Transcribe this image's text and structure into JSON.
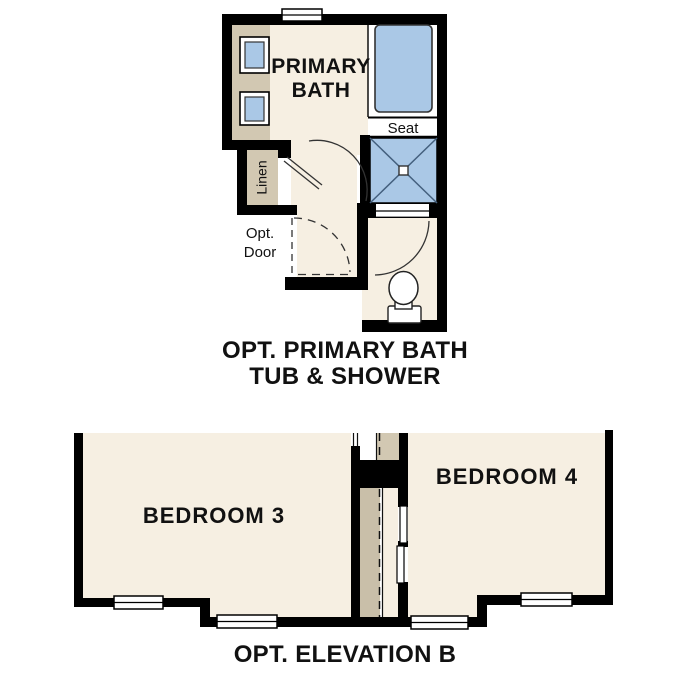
{
  "colors": {
    "wall": "#000000",
    "cream": "#f6efe2",
    "tan": "#d2c8b2",
    "tan_dark": "#c9bfa9",
    "fixture_blue": "#aac8e6",
    "shower_diag": "#44607e",
    "line": "#333333"
  },
  "bath_plan": {
    "room_label": "PRIMARY\nBATH",
    "seat_label": "Seat",
    "linen_label": "Linen",
    "opt_door_label": "Opt.\nDoor",
    "caption": "OPT. PRIMARY BATH\nTUB & SHOWER"
  },
  "elevation_plan": {
    "bedroom3_label": "BEDROOM 3",
    "bedroom4_label": "BEDROOM 4",
    "caption": "OPT. ELEVATION B"
  }
}
